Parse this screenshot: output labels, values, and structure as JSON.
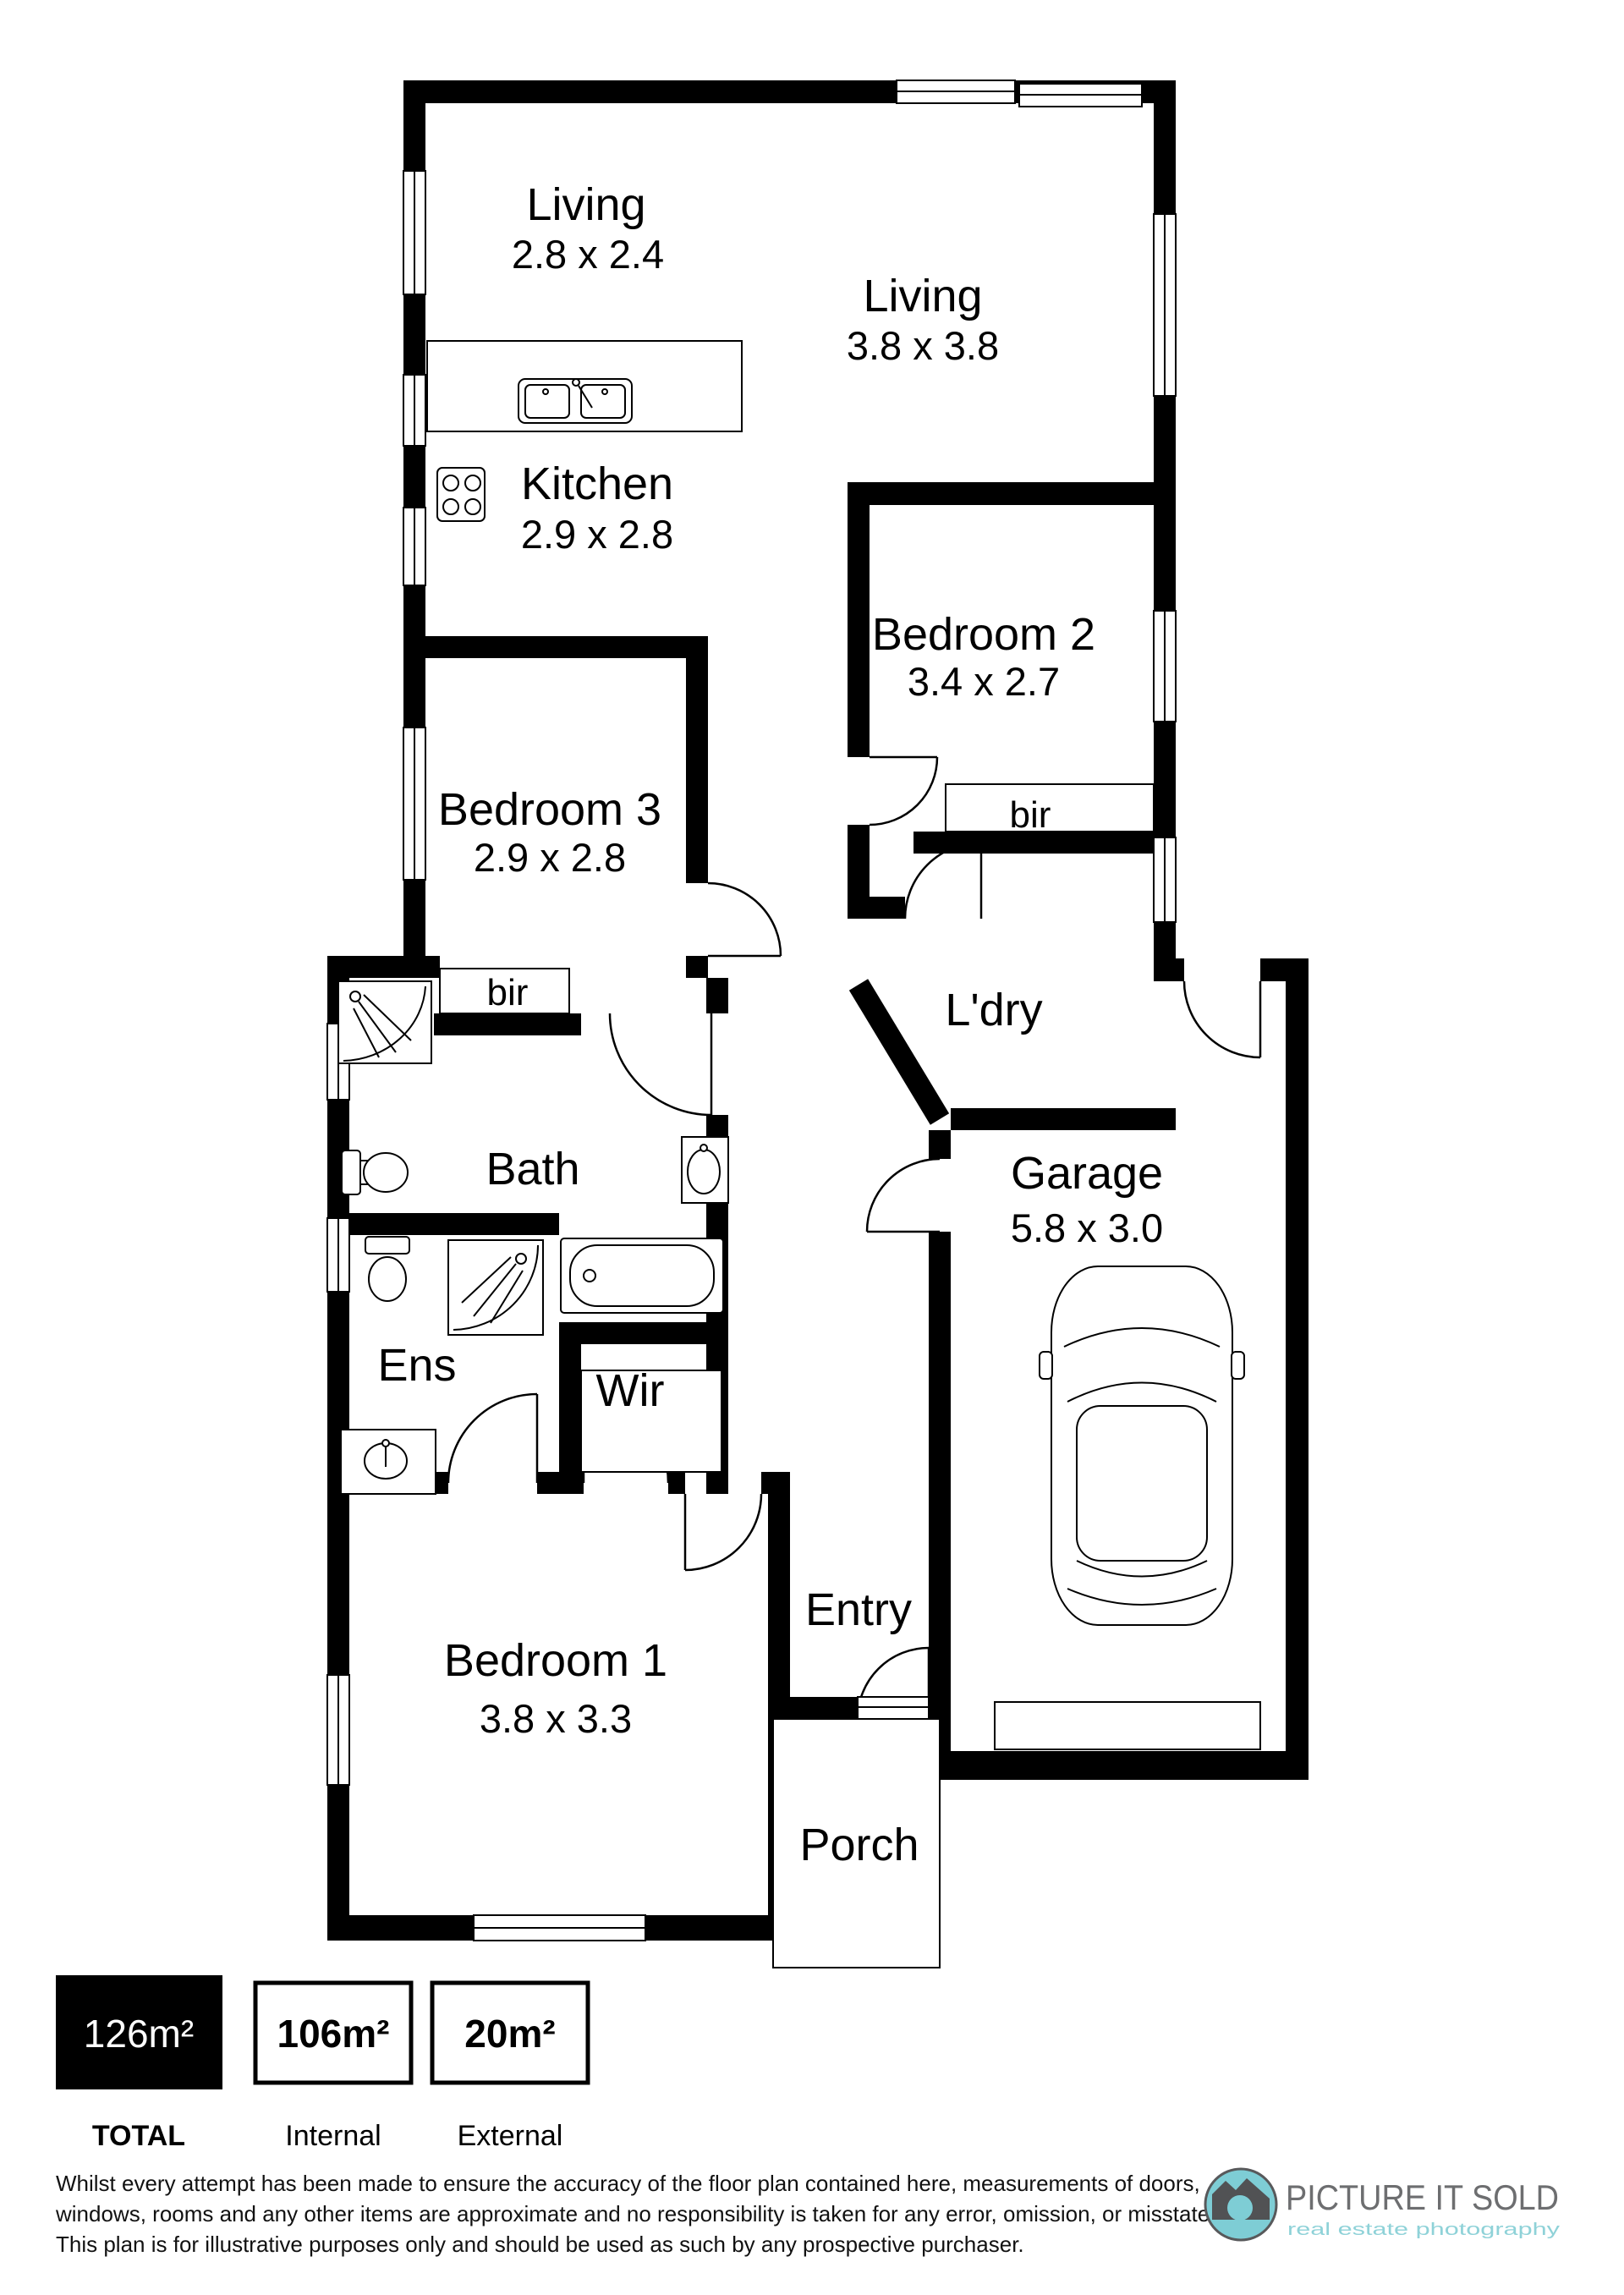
{
  "plan": {
    "rooms": {
      "living1": {
        "label": "Living",
        "dims": "2.8 x 2.4"
      },
      "living2": {
        "label": "Living",
        "dims": "3.8 x 3.8"
      },
      "kitchen": {
        "label": "Kitchen",
        "dims": "2.9 x 2.8"
      },
      "bedroom2": {
        "label": "Bedroom 2",
        "dims": "3.4 x 2.7"
      },
      "bedroom3": {
        "label": "Bedroom 3",
        "dims": "2.9 x 2.8"
      },
      "bedroom1": {
        "label": "Bedroom 1",
        "dims": "3.8 x 3.3"
      },
      "garage": {
        "label": "Garage",
        "dims": "5.8 x 3.0"
      },
      "laundry": {
        "label": "L'dry"
      },
      "bath": {
        "label": "Bath"
      },
      "ens": {
        "label": "Ens"
      },
      "wir": {
        "label": "Wir"
      },
      "bir_bed2": {
        "label": "bir"
      },
      "bir_bed3": {
        "label": "bir"
      },
      "entry": {
        "label": "Entry"
      },
      "porch": {
        "label": "Porch"
      }
    }
  },
  "legend": {
    "total": {
      "value": "126m²",
      "label": "TOTAL"
    },
    "internal": {
      "value": "106m²",
      "label": "Internal"
    },
    "external": {
      "value": "20m²",
      "label": "External"
    }
  },
  "disclaimer": {
    "line1": "Whilst every attempt has been made to ensure the accuracy of the floor plan contained here, measurements of doors,",
    "line2": "windows, rooms and any other items are approximate and no responsibility is taken for any error, omission, or misstatement.",
    "line3": "This plan is for illustrative purposes only and should be used as such by any prospective purchaser."
  },
  "logo": {
    "name": "PICTURE IT SOLD",
    "tagline": "real estate photography"
  },
  "colors": {
    "teal": "#7ecdd5",
    "gray": "#6d6e70",
    "camera_dark": "#515254"
  }
}
